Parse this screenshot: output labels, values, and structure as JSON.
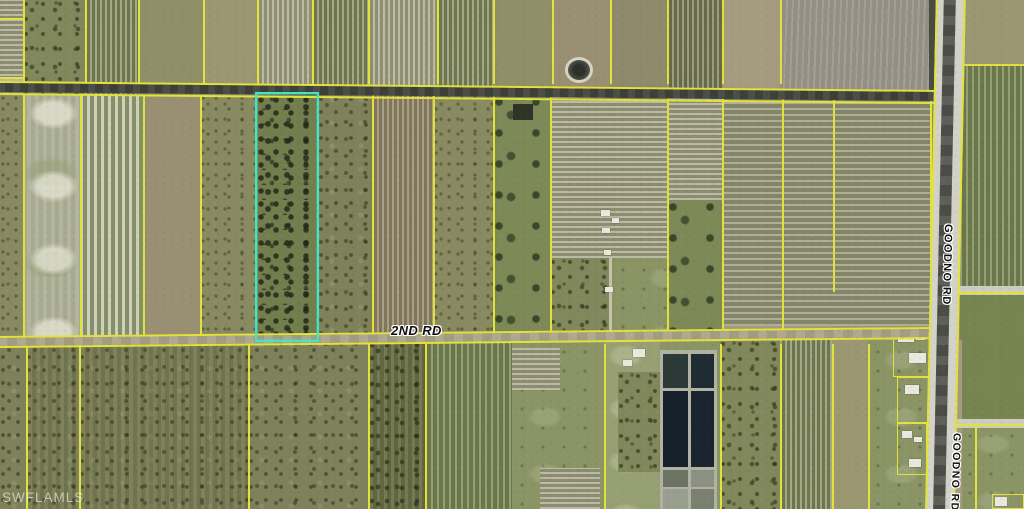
{
  "map": {
    "labels": {
      "second_rd": "2ND RD",
      "goodno_rd": "GOODNO RD"
    },
    "watermark": "SWFLAMLS",
    "colors": {
      "parcel_line": "#e3e23a",
      "highlight": "#41e6c9",
      "top_road": "#42453d",
      "second_road_surface": "#aaa489",
      "goodno_shoulder": "#d2d2c8",
      "goodno_center": "#54554e",
      "label_text": "#0d0d0d",
      "label_halo": "#ffffff",
      "building": "#eae8de"
    },
    "highlight_parcel": {
      "x": 255,
      "y": 92,
      "w": 64,
      "h": 250
    },
    "fields": [
      [
        0,
        0,
        23,
        96,
        "rowsHL"
      ],
      [
        23,
        0,
        62,
        96,
        "trees"
      ],
      [
        85,
        0,
        53,
        96,
        "rowsVG"
      ],
      [
        138,
        0,
        65,
        96,
        "olive"
      ],
      [
        203,
        0,
        54,
        96,
        "olive2"
      ],
      [
        257,
        0,
        55,
        96,
        "rowsVL"
      ],
      [
        312,
        0,
        56,
        96,
        "rowsVG"
      ],
      [
        368,
        0,
        69,
        96,
        "rowsVL"
      ],
      [
        437,
        0,
        56,
        96,
        "rowsVG"
      ],
      [
        493,
        0,
        59,
        96,
        "olive"
      ],
      [
        552,
        0,
        58,
        96,
        "brown"
      ],
      [
        610,
        0,
        57,
        96,
        "brown2"
      ],
      [
        667,
        0,
        55,
        96,
        "rowsVD"
      ],
      [
        722,
        0,
        58,
        96,
        "tan"
      ],
      [
        780,
        0,
        160,
        96,
        "graybrown"
      ],
      [
        960,
        0,
        64,
        64,
        "olive2"
      ],
      [
        960,
        64,
        64,
        230,
        "rowsVG2"
      ],
      [
        960,
        294,
        64,
        130,
        "green2"
      ],
      [
        960,
        424,
        64,
        85,
        "pasture2"
      ],
      [
        0,
        95,
        25,
        243,
        "scrub"
      ],
      [
        25,
        95,
        55,
        243,
        "pastureL"
      ],
      [
        80,
        95,
        63,
        243,
        "rowsVW"
      ],
      [
        143,
        95,
        57,
        243,
        "brown"
      ],
      [
        200,
        95,
        57,
        243,
        "scrub"
      ],
      [
        318,
        95,
        54,
        243,
        "scrub2"
      ],
      [
        372,
        95,
        61,
        243,
        "rowsVBr"
      ],
      [
        433,
        95,
        60,
        243,
        "scrub"
      ],
      [
        493,
        95,
        57,
        243,
        "greentrees"
      ],
      [
        550,
        95,
        117,
        163,
        "rowsHL"
      ],
      [
        550,
        258,
        117,
        80,
        "pasture2"
      ],
      [
        550,
        258,
        62,
        80,
        "trees"
      ],
      [
        667,
        95,
        55,
        105,
        "rowsHL"
      ],
      [
        667,
        200,
        55,
        138,
        "greentrees"
      ],
      [
        722,
        95,
        60,
        231,
        "rowsH"
      ],
      [
        722,
        326,
        60,
        14,
        "tan"
      ],
      [
        782,
        95,
        51,
        231,
        "rowsH"
      ],
      [
        782,
        326,
        51,
        14,
        "tan"
      ],
      [
        833,
        95,
        97,
        231,
        "rowsH"
      ],
      [
        833,
        326,
        97,
        14,
        "olive2"
      ],
      [
        257,
        95,
        61,
        246,
        "treesD"
      ],
      [
        0,
        340,
        26,
        169,
        "scrub2"
      ],
      [
        26,
        340,
        53,
        169,
        "scrubV"
      ],
      [
        79,
        340,
        169,
        169,
        "scrubV"
      ],
      [
        248,
        340,
        120,
        169,
        "scrub2"
      ],
      [
        368,
        340,
        57,
        169,
        "scrubVD"
      ],
      [
        425,
        340,
        87,
        169,
        "rowsVG2"
      ],
      [
        512,
        340,
        92,
        169,
        "pasture2"
      ],
      [
        512,
        348,
        48,
        42,
        "rowsHL"
      ],
      [
        540,
        468,
        60,
        41,
        "rowsHL"
      ],
      [
        604,
        340,
        56,
        169,
        "pasture"
      ],
      [
        618,
        372,
        42,
        100,
        "trees"
      ],
      [
        660,
        340,
        60,
        169,
        "pasture2"
      ],
      [
        720,
        340,
        60,
        169,
        "trees"
      ],
      [
        780,
        340,
        52,
        169,
        "rowsVG"
      ],
      [
        832,
        340,
        36,
        169,
        "olive2"
      ],
      [
        868,
        340,
        62,
        169,
        "pasture2"
      ],
      [
        930,
        340,
        32,
        169,
        "tan"
      ]
    ],
    "patches": [
      [
        513,
        104,
        20,
        16,
        "#2e3428"
      ],
      [
        929,
        0,
        13,
        96,
        "#474b41"
      ],
      [
        609,
        258,
        3,
        80,
        "#c6c1aa"
      ],
      [
        956,
        286,
        68,
        9,
        "#ccccc2"
      ],
      [
        952,
        419,
        72,
        9,
        "#ccccc2"
      ],
      [
        660,
        350,
        57,
        159,
        "#b2b2a4"
      ],
      [
        663,
        354,
        25,
        34,
        "#2c3a37"
      ],
      [
        691,
        354,
        23,
        34,
        "#202c34"
      ],
      [
        663,
        391,
        25,
        76,
        "#16202a"
      ],
      [
        691,
        391,
        23,
        76,
        "#1b2530"
      ],
      [
        663,
        470,
        25,
        17,
        "#6d7464"
      ],
      [
        691,
        470,
        23,
        17,
        "#8d9184"
      ],
      [
        663,
        489,
        25,
        20,
        "#9a9e8e"
      ],
      [
        691,
        489,
        23,
        20,
        "#7b8171"
      ]
    ],
    "vlines": [
      [
        23,
        0,
        84
      ],
      [
        85,
        0,
        84
      ],
      [
        138,
        0,
        84
      ],
      [
        203,
        0,
        84
      ],
      [
        257,
        0,
        84
      ],
      [
        312,
        0,
        84
      ],
      [
        368,
        0,
        84
      ],
      [
        437,
        0,
        84
      ],
      [
        493,
        0,
        84
      ],
      [
        552,
        0,
        84
      ],
      [
        610,
        0,
        84
      ],
      [
        667,
        0,
        84
      ],
      [
        722,
        0,
        84
      ],
      [
        780,
        0,
        84
      ],
      [
        940,
        0,
        90
      ],
      [
        23,
        95,
        338
      ],
      [
        80,
        95,
        338
      ],
      [
        143,
        95,
        338
      ],
      [
        200,
        95,
        338
      ],
      [
        372,
        95,
        338
      ],
      [
        433,
        95,
        338
      ],
      [
        493,
        95,
        338
      ],
      [
        550,
        95,
        338
      ],
      [
        667,
        95,
        338
      ],
      [
        722,
        95,
        338
      ],
      [
        782,
        95,
        338
      ],
      [
        833,
        95,
        292
      ],
      [
        930,
        95,
        336
      ],
      [
        26,
        344,
        509
      ],
      [
        79,
        344,
        509
      ],
      [
        248,
        344,
        509
      ],
      [
        368,
        344,
        509
      ],
      [
        425,
        344,
        509
      ],
      [
        604,
        344,
        509
      ],
      [
        720,
        344,
        509
      ],
      [
        780,
        344,
        509
      ],
      [
        832,
        344,
        509
      ],
      [
        868,
        344,
        509
      ],
      [
        930,
        342,
        509
      ],
      [
        975,
        424,
        509
      ]
    ],
    "hlines": [
      [
        18,
        0,
        23
      ],
      [
        77,
        0,
        23
      ],
      [
        64,
        960,
        1024
      ],
      [
        292,
        958,
        1024
      ],
      [
        424,
        956,
        1024
      ]
    ],
    "parcel_rects": [
      [
        893,
        330,
        52,
        47
      ],
      [
        897,
        377,
        32,
        46
      ],
      [
        897,
        423,
        30,
        52
      ],
      [
        992,
        494,
        32,
        15
      ]
    ],
    "buildings": [
      [
        633,
        349,
        12,
        8
      ],
      [
        623,
        360,
        9,
        6
      ],
      [
        601,
        210,
        9,
        6
      ],
      [
        612,
        218,
        7,
        5
      ],
      [
        602,
        228,
        8,
        5
      ],
      [
        604,
        250,
        7,
        5
      ],
      [
        605,
        287,
        8,
        5
      ],
      [
        898,
        333,
        16,
        9
      ],
      [
        916,
        334,
        9,
        6
      ],
      [
        909,
        353,
        17,
        10
      ],
      [
        905,
        385,
        14,
        9
      ],
      [
        902,
        431,
        10,
        7
      ],
      [
        914,
        437,
        8,
        5
      ],
      [
        909,
        459,
        12,
        8
      ],
      [
        995,
        497,
        12,
        9
      ]
    ],
    "ovals": [
      [
        565,
        57,
        28,
        26
      ]
    ]
  }
}
